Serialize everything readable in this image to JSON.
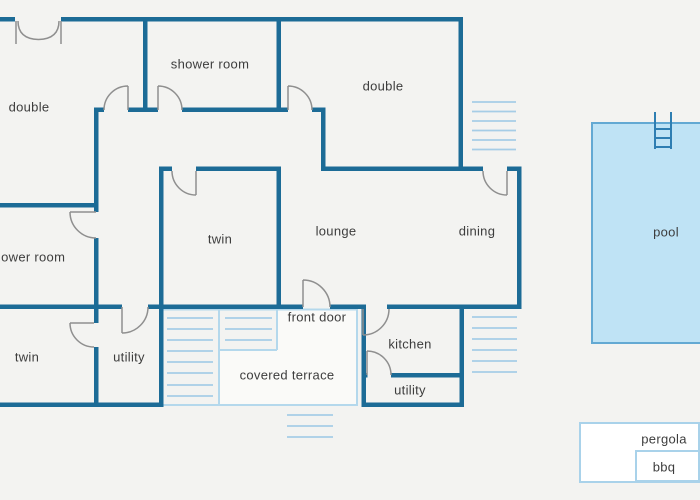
{
  "plan": {
    "labels": [
      {
        "id": "double-top-left",
        "text": "double"
      },
      {
        "id": "shower-room-top",
        "text": "shower room"
      },
      {
        "id": "double-top-right",
        "text": "double"
      },
      {
        "id": "shower-room-left",
        "text": "shower room"
      },
      {
        "id": "twin-middle",
        "text": "twin"
      },
      {
        "id": "lounge",
        "text": "lounge"
      },
      {
        "id": "dining",
        "text": "dining"
      },
      {
        "id": "twin-bottom",
        "text": "twin"
      },
      {
        "id": "utility-left",
        "text": "utility"
      },
      {
        "id": "front-door",
        "text": "front door"
      },
      {
        "id": "covered-terrace",
        "text": "covered terrace"
      },
      {
        "id": "kitchen",
        "text": "kitchen"
      },
      {
        "id": "utility-right",
        "text": "utility"
      },
      {
        "id": "pool",
        "text": "pool"
      },
      {
        "id": "pergola",
        "text": "pergola"
      },
      {
        "id": "bbq",
        "text": "bbq"
      }
    ],
    "colors": {
      "wall": "#1c6b96",
      "door_arc": "#8f8f8f",
      "hatch": "#a6cde6",
      "pool_fill": "#bfe3f5",
      "pool_border": "#63a9d3",
      "light_outline": "#a9d2ea",
      "background": "#f3f3f1",
      "text": "#3d3d3d"
    }
  }
}
